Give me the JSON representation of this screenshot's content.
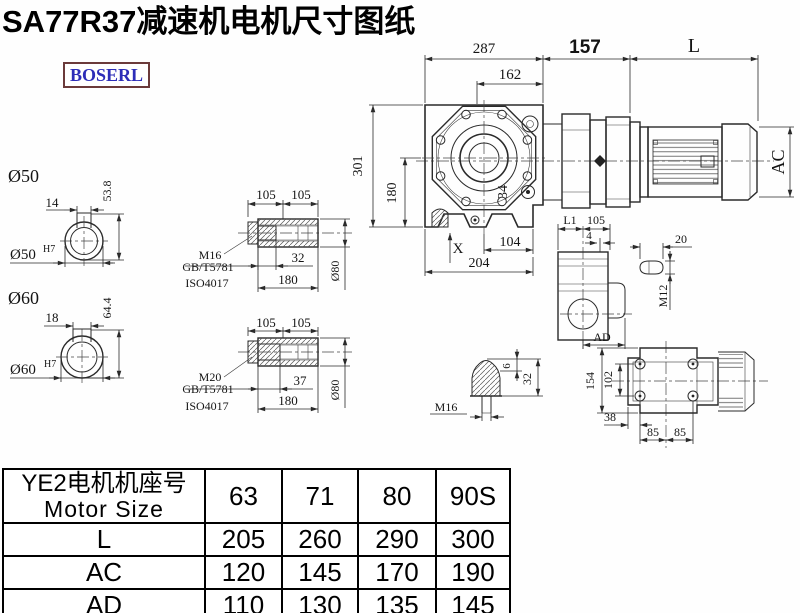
{
  "title": "SA77R37减速机电机尺寸图纸",
  "logo": {
    "text": "BOSERL"
  },
  "colors": {
    "line": "#2a2a2a",
    "title": "#000000",
    "logo_text": "#2d2db8",
    "logo_border": "#6b3a3a",
    "background": "#fefefe"
  },
  "main_view": {
    "width_total": "287",
    "width_inner": "162",
    "adapter_len": "157",
    "motor_len": "L",
    "motor_dia": "AC",
    "height_total": "301",
    "height_center": "180",
    "tilt": "34",
    "x_ref": "X",
    "base_inner": "104",
    "base_total": "204"
  },
  "shaft_50": {
    "title": "Ø50",
    "key_width": "14",
    "key_height": "53.8",
    "bore": "Ø50",
    "tolerance": "H7"
  },
  "shaft_60": {
    "title": "Ø60",
    "key_width": "18",
    "key_height": "64.4",
    "bore": "Ø60",
    "tolerance": "H7"
  },
  "hollow_shaft_50": {
    "seg1": "105",
    "seg2": "105",
    "depth": "32",
    "length": "180",
    "dia": "Ø80",
    "thread": "M16",
    "standard1": "GB/T5781",
    "standard2": "ISO4017"
  },
  "hollow_shaft_60": {
    "seg1": "105",
    "seg2": "105",
    "depth": "37",
    "length": "180",
    "dia": "Ø80",
    "thread": "M20",
    "standard1": "GB/T5781",
    "standard2": "ISO4017"
  },
  "side_view": {
    "l1": "L1",
    "width": "105",
    "offset": "4",
    "ad": "AD"
  },
  "key_detail": {
    "length": "20",
    "thread": "M12"
  },
  "plug_detail": {
    "thread": "M16",
    "tip": "6",
    "height": "32"
  },
  "flange_view": {
    "height": "154",
    "bolt_span": "102",
    "offset": "38",
    "pitch1": "85",
    "pitch2": "85"
  },
  "table": {
    "header": {
      "line1": "YE2电机机座号",
      "line2": "Motor Size"
    },
    "columns": [
      "63",
      "71",
      "80",
      "90S"
    ],
    "rows": [
      {
        "label": "L",
        "values": [
          "205",
          "260",
          "290",
          "300"
        ]
      },
      {
        "label": "AC",
        "values": [
          "120",
          "145",
          "170",
          "190"
        ]
      },
      {
        "label": "AD",
        "values": [
          "110",
          "130",
          "135",
          "145"
        ]
      }
    ]
  }
}
